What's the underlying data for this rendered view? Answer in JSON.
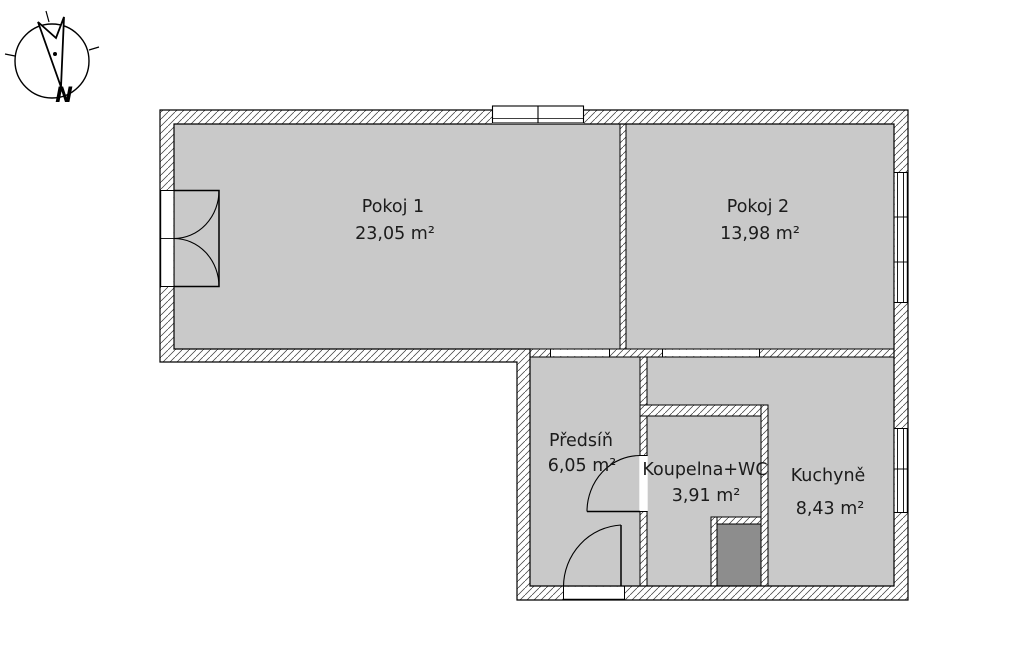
{
  "document": {
    "type": "apartment-floor-plan",
    "background_color": "#ffffff"
  },
  "compass": {
    "north_label": "N"
  },
  "rooms": [
    {
      "name": "Pokoj 1",
      "area": "23,05 m²"
    },
    {
      "name": "Pokoj 2",
      "area": "13,98 m²"
    },
    {
      "name": "Předsíň",
      "area": "6,05 m²"
    },
    {
      "name": "Koupelna+WC",
      "area": "3,91 m²"
    },
    {
      "name": "Kuchyně",
      "area": "8,43 m²"
    }
  ],
  "colors": {
    "room_fill": "#c9c9c9",
    "shaft_fill": "#8d8d8d",
    "wall_line": "#000000",
    "hatch_line": "#3a3a3a",
    "label_text": "#1c1c1c"
  }
}
